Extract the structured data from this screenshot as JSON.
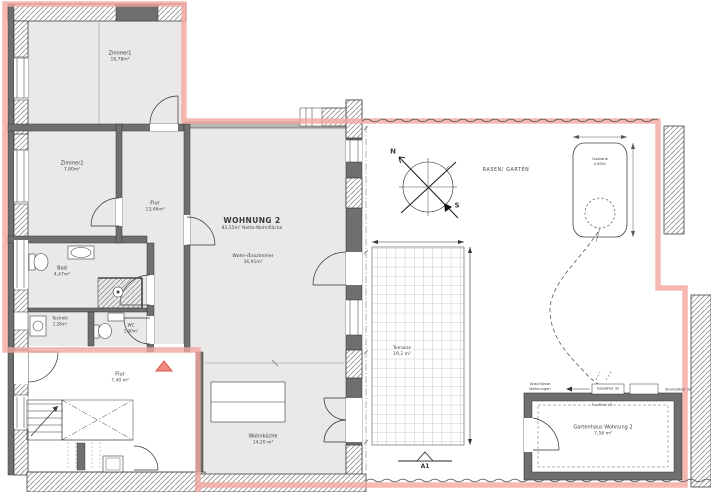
{
  "apartment": {
    "title": "WOHNUNG 2",
    "subtitle": "83,55m² Netto-Wohnfläche"
  },
  "rooms": {
    "zimmer1": {
      "name": "Zimmer1",
      "area": "16,78m²"
    },
    "zimmer2": {
      "name": "Zimmer2",
      "area": "7,80m²"
    },
    "flur_og": {
      "name": "Flur",
      "area": "13,46m²"
    },
    "bad": {
      "name": "Bad",
      "area": "4,47m²"
    },
    "technik": {
      "name": "Technik",
      "area": "1,28m²"
    },
    "wc": {
      "name": "WC",
      "area": "1,40m²"
    },
    "wohnzimmer": {
      "name": "Wohn-/Esszimmer",
      "area": "36,91m²"
    },
    "flur_eg": {
      "name": "Flur",
      "area": "7,40 m²"
    },
    "wohnkueche": {
      "name": "Wohnküche",
      "area": "14,20 m²"
    }
  },
  "outdoor": {
    "rasen": "RASEN/ GARTEN",
    "terrasse": {
      "name": "Terrasse",
      "area": "19,2 m²"
    },
    "gastank": {
      "name": "Gastank",
      "capacity": "4.850L"
    },
    "gartenhaus": {
      "name": "Gartenhaus Wohnung 2",
      "area": "7,56 m²"
    },
    "trauflinie": "Trauflinie VD"
  },
  "annotations": {
    "anschluesse_line1": "Anschlüsse",
    "anschluesse_line2": "Wohnungen",
    "gaszaehler": "Gaszähler 3x",
    "stromzaehler": "Stromzähler 3x",
    "section": "A1",
    "north": "N",
    "south": "S"
  },
  "colors": {
    "boundary": "#f2a6a0",
    "room_fill": "#ebe9e7",
    "wall": "#6f6f6f",
    "entry_marker": "#ef8a80"
  }
}
